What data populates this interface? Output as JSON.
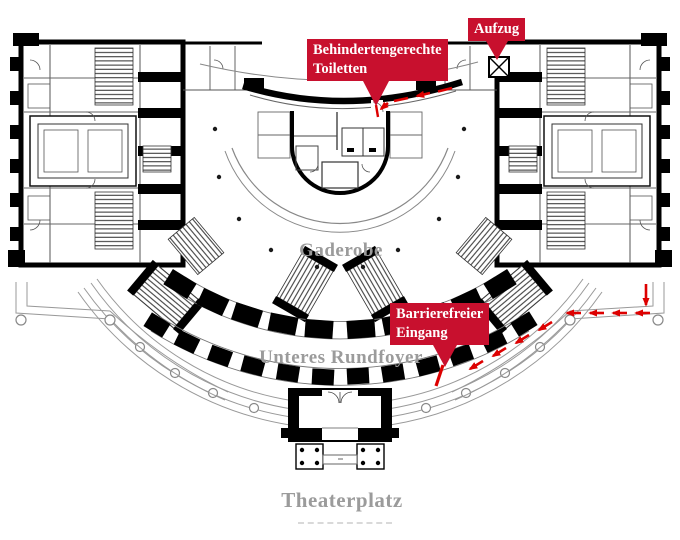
{
  "plan": {
    "area_labels": {
      "garderobe": "Gaderobe",
      "lower_round_foyer": "Unteres Rundfoyer",
      "theater_square": "Theaterplatz"
    },
    "callouts": {
      "accessible_toilets": {
        "line1": "Behindertengerechte",
        "line2": "Toiletten"
      },
      "elevator": {
        "label": "Aufzug"
      },
      "accessible_entrance": {
        "line1": "Barrierefreier",
        "line2": "Eingang"
      }
    },
    "colors": {
      "callout_background": "#C8102E",
      "callout_text": "#FFFFFF",
      "route_arrows": "#DD0000",
      "area_label_gray": "#9B9B9B",
      "plan_lines": "#000000"
    }
  }
}
